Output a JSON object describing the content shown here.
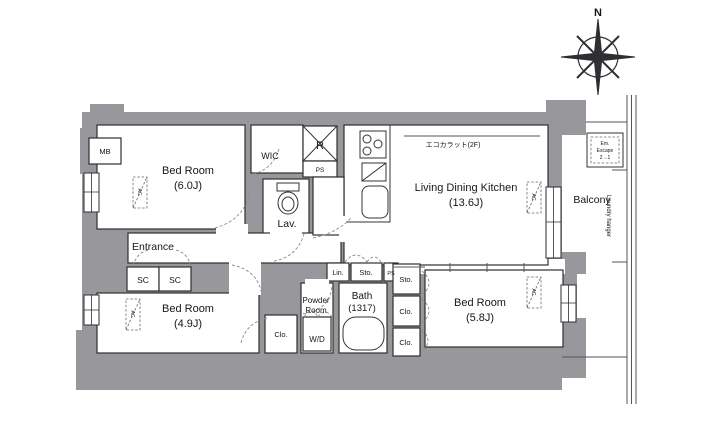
{
  "compass": {
    "north": "N"
  },
  "rooms": {
    "bedroom_main": {
      "name": "Bed Room",
      "size": "(6.0J)"
    },
    "wic": {
      "name": "WIC"
    },
    "lav": {
      "name": "Lav."
    },
    "entrance": {
      "name": "Entrance"
    },
    "ldk": {
      "name": "Living Dining Kitchen",
      "size": "(13.6J)"
    },
    "bedroom_small": {
      "name": "Bed Room",
      "size": "(4.9J)"
    },
    "bedroom_east": {
      "name": "Bed Room",
      "size": "(5.8J)"
    },
    "bath": {
      "name": "Bath",
      "size": "(1317)"
    },
    "powder": {
      "line1": "Powder",
      "line2": "Room"
    },
    "balcony": {
      "name": "Balcony"
    }
  },
  "storage": {
    "sc_left": "SC",
    "sc_right": "SC",
    "lin": "Lin.",
    "sto_hall": "Sto.",
    "sto_east": "Sto.",
    "clo_bedroom": "Clo.",
    "clo_east_upper": "Clo.",
    "clo_east_lower": "Clo."
  },
  "equipment": {
    "mb": "MB",
    "refrigerator": "R",
    "ps_shaft_top": "PS",
    "ps_shaft_hall": "PS",
    "washer_dryer": "W/D",
    "ac_bedroom_main": "AC",
    "ac_bedroom_small": "AC",
    "ac_ldk": "AC",
    "ac_bedroom_east": "AC"
  },
  "annotations": {
    "ecocarat": "エコカラット(2F)",
    "laundry_hanger": "Laundry hanger",
    "escape_hatch": {
      "line1": "Em.",
      "line2": "Escape",
      "line3": "2→1"
    }
  }
}
